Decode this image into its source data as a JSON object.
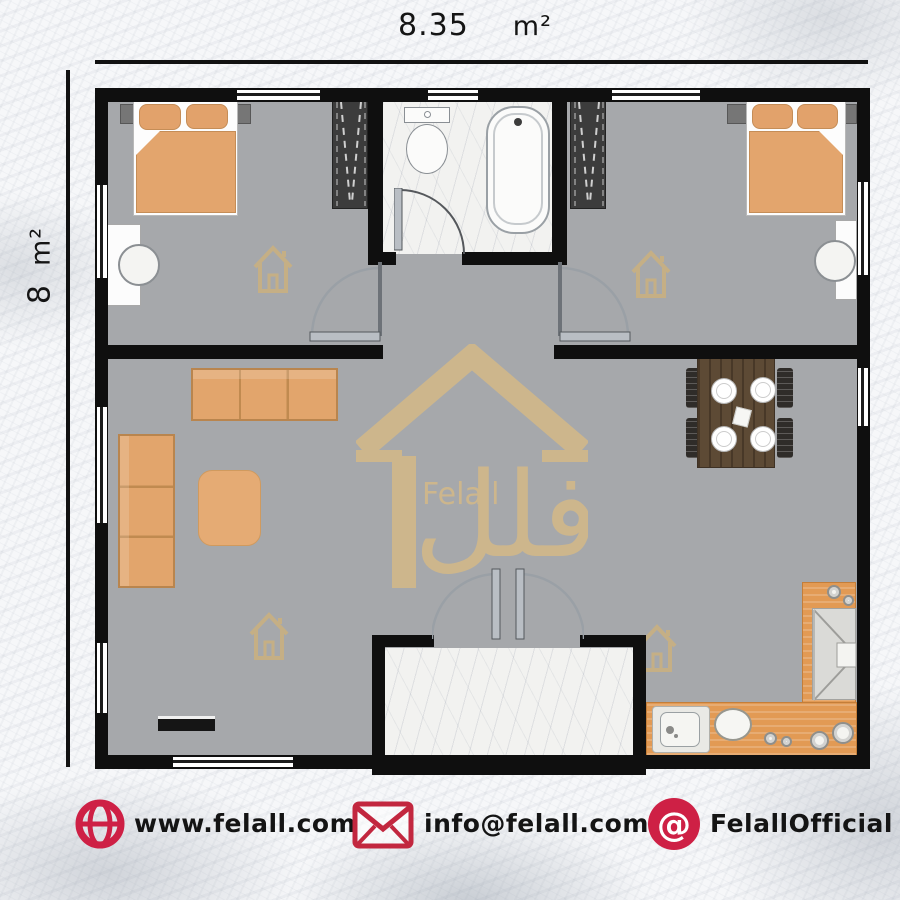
{
  "dimensions": {
    "width": {
      "value": "8.35",
      "unit": "m²"
    },
    "height": {
      "value": "8",
      "unit": "m²"
    }
  },
  "watermark": {
    "brand_latin": "Felall",
    "brand_arabic": "فلل"
  },
  "footer": {
    "website": "www.felall.com",
    "email": "info@felall.com",
    "social": "FelallOfficial"
  },
  "icons": {
    "website": "globe-icon",
    "email": "envelope-icon",
    "social": "at-badge-icon",
    "watermark": "house-logo-icon"
  },
  "palette": {
    "accent_red": "#ce2045",
    "wall_black": "#0f0f0f",
    "floor_gray": "#a6a8ab",
    "marble_white": "#f2f2f0",
    "furniture_orange": "#e2a36c",
    "counter_orange": "#e29a54",
    "wood_brown": "#5d4a35",
    "watermark_gold": "#d8bb84",
    "text_black": "#141414"
  }
}
